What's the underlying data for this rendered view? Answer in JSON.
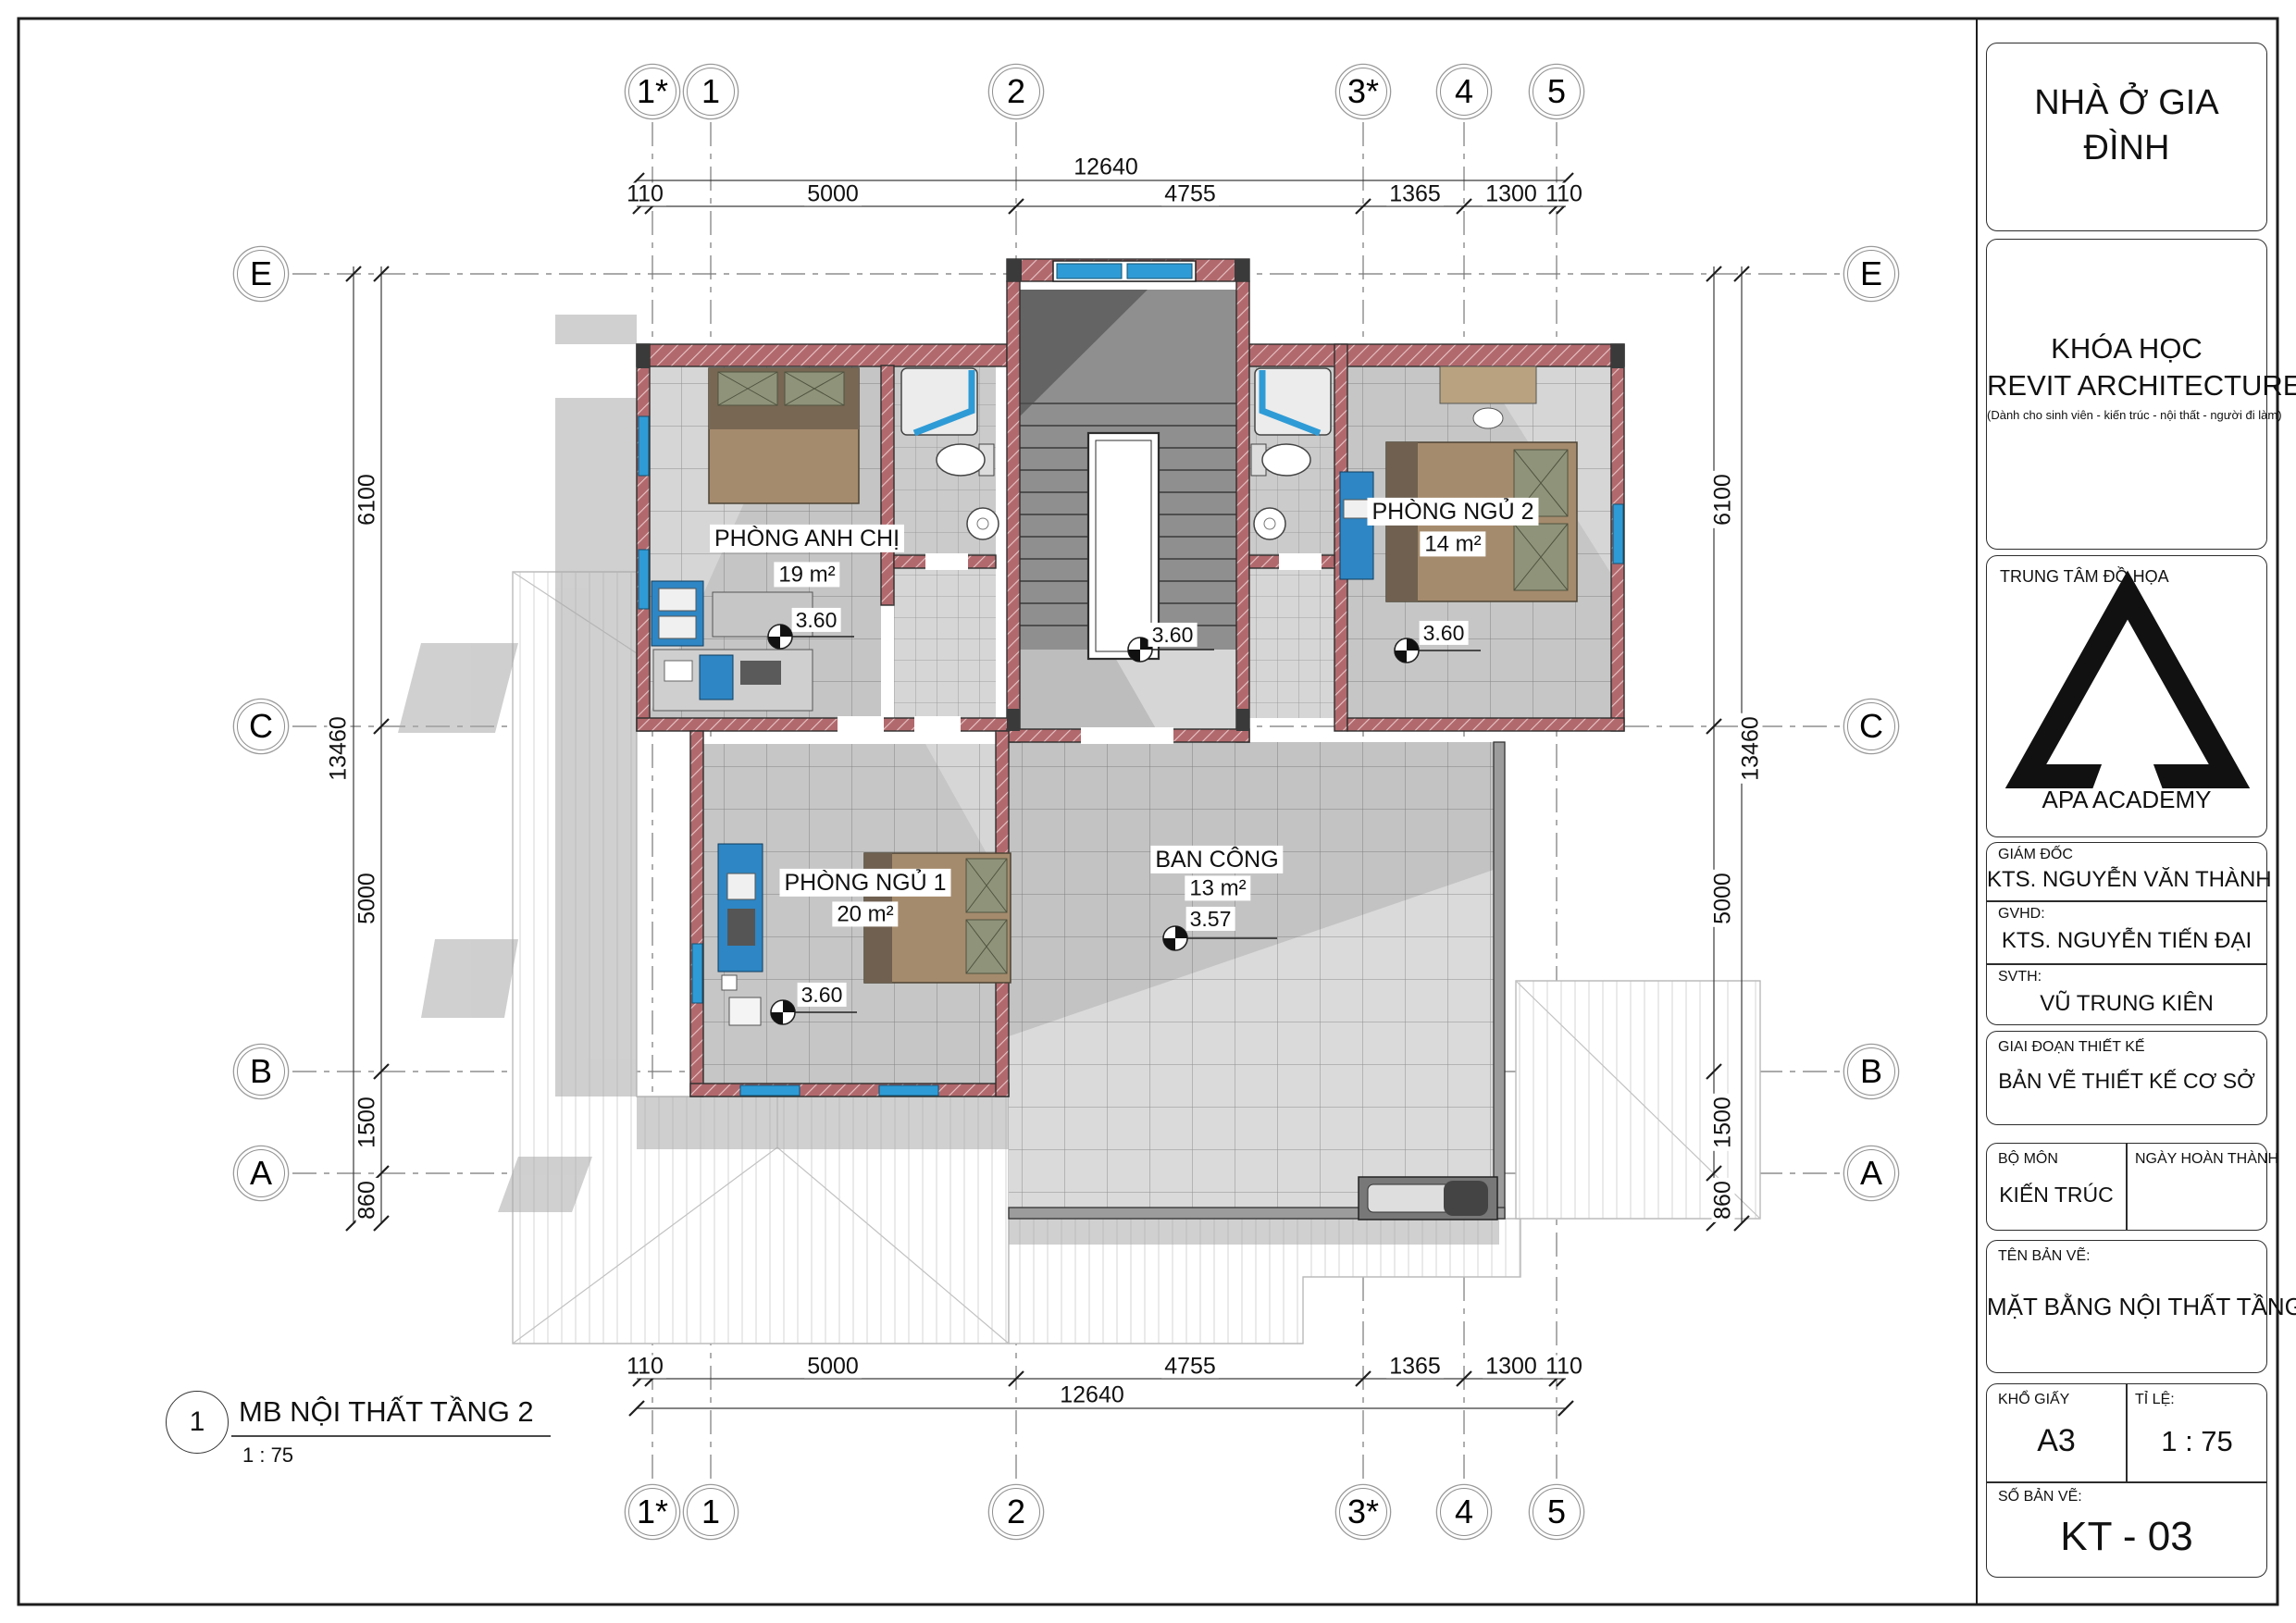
{
  "title_block": {
    "project": "NHÀ Ở GIA ĐÌNH",
    "course_line1": "KHÓA HỌC",
    "course_line2": "REVIT ARCHITECTURE",
    "course_note": "(Dành cho sinh viên - kiến trúc - nội thất - người đi làm)",
    "center_label": "TRUNG TÂM ĐỒ HỌA",
    "center_name": "APA ACADEMY",
    "director_label": "GIÁM ĐỐC",
    "director": "KTS. NGUYỄN VĂN THÀNH",
    "advisor_label": "GVHD:",
    "advisor": "KTS. NGUYỄN TIẾN ĐẠI",
    "student_label": "SVTH:",
    "student": "VŨ TRUNG KIÊN",
    "phase_label": "GIAI ĐOẠN THIẾT KẾ",
    "phase": "BẢN VẼ THIẾT KẾ CƠ SỞ",
    "dept_label": "BỘ MÔN",
    "dept": "KIẾN TRÚC",
    "date_label": "NGÀY HOÀN THÀNH",
    "drawing_name_label": "TÊN BẢN VẼ:",
    "drawing_name": "MẶT BẰNG NỘI THẤT TẦNG 2",
    "paper_label": "KHỔ GIẤY",
    "paper": "A3",
    "scale_label": "TỈ LỆ:",
    "scale": "1 : 75",
    "number_label": "SỐ BẢN VẼ:",
    "number": "KT - 03"
  },
  "view_title": {
    "number": "1",
    "name": "MB NỘI THẤT TẦNG 2",
    "scale": "1 : 75"
  },
  "grids": {
    "columns": [
      "1*",
      "1",
      "2",
      "3*",
      "4",
      "5"
    ],
    "rows": [
      "E",
      "C",
      "B",
      "A"
    ]
  },
  "dimensions": {
    "horizontal_total": "12640",
    "horizontal_segments": [
      "110",
      "5000",
      "4755",
      "1365",
      "1300",
      "110"
    ],
    "vertical_total": "13460",
    "vertical_segments": [
      "6100",
      "5000",
      "1500",
      "860"
    ]
  },
  "rooms": [
    {
      "name": "PHÒNG ANH CHỊ",
      "area": "19 m²",
      "elevation": "3.60"
    },
    {
      "name": "PHÒNG NGỦ 2",
      "area": "14 m²",
      "elevation": "3.60"
    },
    {
      "name": "PHÒNG NGỦ 1",
      "area": "20 m²",
      "elevation": "3.60"
    },
    {
      "name": "BAN CÔNG",
      "area": "13 m²",
      "elevation": "3.57"
    }
  ],
  "hall_elevation": "3.60",
  "colors": {
    "wall": "#b2696d",
    "window_blue": "#2f9bd6",
    "furniture_blue": "#2e86c4",
    "bed_tan": "#a58b6d",
    "pillow_olive": "#8f9379"
  }
}
